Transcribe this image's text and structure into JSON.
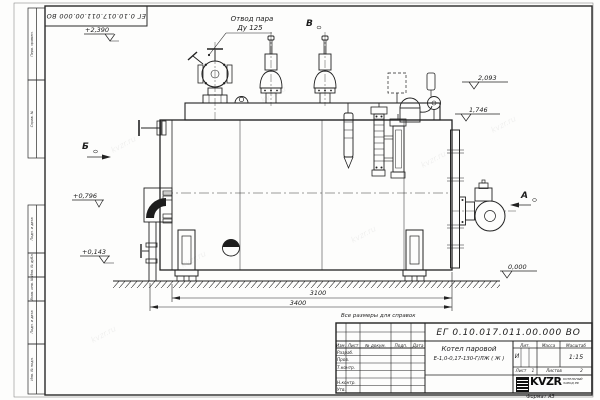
{
  "watermark": "kvzr.ru",
  "frame": {
    "top_stamp": "ЕГ 0.10.017.011.00.000  ВО",
    "side_labels": [
      "Перв. примен.",
      "Справ. №",
      "Подп. и дата",
      "Инв. № дубл.",
      "Взам. инв. №",
      "Подп. и дата",
      "Инв. № подл."
    ],
    "format_note": "Формат А3"
  },
  "callouts": {
    "steam_outlet_line1": "Отвод пара",
    "steam_outlet_line2": "Ду 125",
    "note": "Все размеры для справок"
  },
  "views": {
    "a": "А",
    "b": "Б",
    "v": "В"
  },
  "elevations": {
    "top": "+2,390",
    "mid": "+0,796",
    "low": "+0,143",
    "zero": "0,000"
  },
  "dims": {
    "h1": "2,093",
    "h2": "1,746",
    "base": "3100",
    "total": "3400"
  },
  "title_block": {
    "doc_number": "ЕГ 0.10.017.011.00.000  ВО",
    "product_line1": "Котел паровой",
    "product_line2": "Е-1,0-0,17-130-Г/ЛЖ ( Ж )",
    "col_izm": "Изм.",
    "col_list": "Лист",
    "col_ndoc": "№ докум.",
    "col_podp": "Подп.",
    "col_data": "Дата",
    "row_razrab": "Разраб.",
    "row_prov": "Пров.",
    "row_tkontr": "Т.контр.",
    "row_nkontr": "Н.контр.",
    "row_utv": "Утв.",
    "lit": "Лит.",
    "massa": "Масса",
    "masshtab": "Масштаб",
    "lit_value": "И",
    "scale": "1:15",
    "sheet_label": "Лист",
    "sheet_num": "1",
    "sheets_label": "Листов",
    "sheets_num": "2",
    "logo": "KVZR",
    "logo_sub1": "КОТЕЛЬНЫЙ",
    "logo_sub2": "ЗАВОД РФ"
  }
}
